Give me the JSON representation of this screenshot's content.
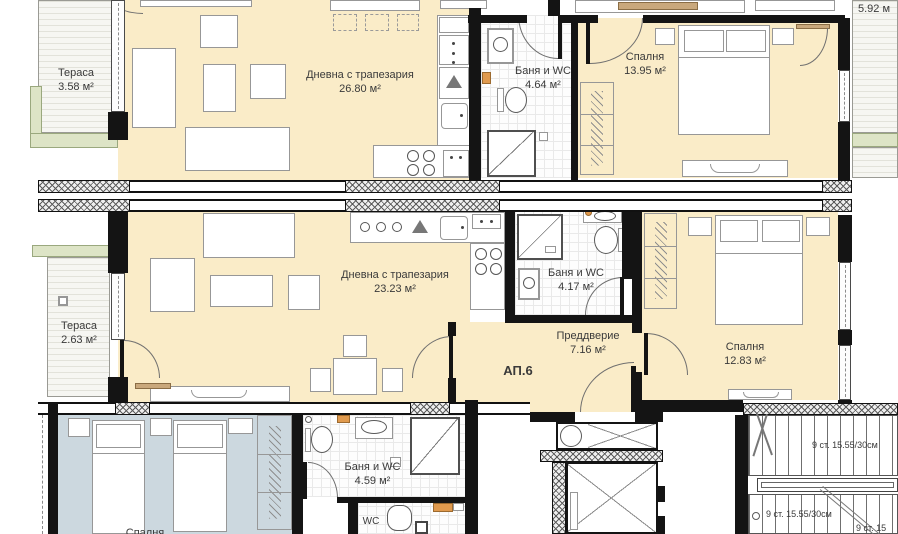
{
  "rooms": {
    "terrace_top": {
      "name": "Тераса",
      "area": "3.58 м²"
    },
    "living_top": {
      "name": "Дневна с трапезария",
      "area": "26.80 м²"
    },
    "bath_top": {
      "name": "Баня и WC",
      "area": "4.64 м²"
    },
    "bedroom_top": {
      "name": "Спалня",
      "area": "13.95 м²"
    },
    "terrace_mid": {
      "name": "Тераса",
      "area": "2.63 м²"
    },
    "living_mid": {
      "name": "Дневна с трапезария",
      "area": "23.23 м²"
    },
    "bath_mid": {
      "name": "Баня и WC",
      "area": "4.17 м²"
    },
    "hallway": {
      "name": "Преддверие",
      "area": "7.16 м²"
    },
    "bedroom_mid": {
      "name": "Спалня",
      "area": "12.83 м²"
    },
    "bath_bottom": {
      "name": "Баня и WC",
      "area": "4.59 м²"
    },
    "wc_bottom": {
      "name": "WC"
    },
    "bedroom_bottom": {
      "name": "Спалня"
    }
  },
  "apartment": {
    "label": "АП.6"
  },
  "dimensions": {
    "terrace_right": "5.92 м"
  },
  "stairs": {
    "labels": [
      "9 ст. 15.55/30см",
      "9 ст. 15.55/30см",
      "9 ст. 15"
    ]
  },
  "colors": {
    "room_fill": "#faecc8",
    "terrace_fill": "#f6f6f2",
    "bedroom_bottom_fill": "#ccd8df",
    "green_accent": "#dde4c6",
    "wall": "#141414"
  }
}
